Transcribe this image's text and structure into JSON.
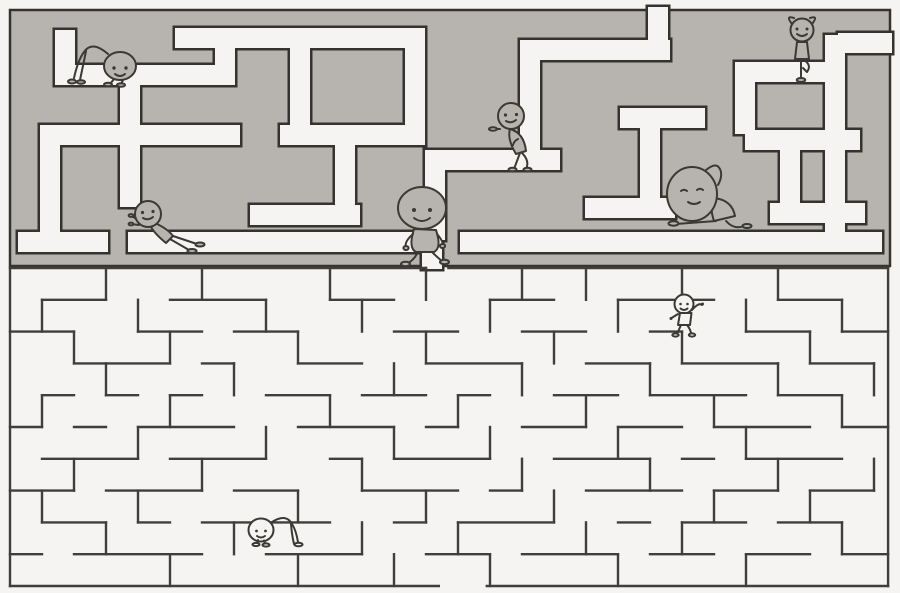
{
  "illustration": {
    "canvas": {
      "width": 900,
      "height": 593
    },
    "colors": {
      "paper": "#f5f4f2",
      "wall_gray": "#b7b4af",
      "line_dark": "#343330",
      "line_maze": "#3f3e3c",
      "char_line": "#3a3936"
    },
    "top_maze": {
      "bounds": [
        10,
        10,
        880,
        256
      ],
      "corridor_width": 20,
      "outline_width": 2.5,
      "corridors": [
        [
          648,
          7,
          20,
          53
        ],
        [
          175,
          28,
          250,
          20
        ],
        [
          520,
          40,
          150,
          20
        ],
        [
          838,
          33,
          54,
          20
        ],
        [
          55,
          30,
          20,
          55
        ],
        [
          55,
          65,
          180,
          20
        ],
        [
          215,
          48,
          20,
          37
        ],
        [
          120,
          85,
          20,
          50
        ],
        [
          40,
          125,
          200,
          20
        ],
        [
          280,
          125,
          145,
          20
        ],
        [
          620,
          108,
          85,
          20
        ],
        [
          745,
          130,
          115,
          20
        ],
        [
          40,
          145,
          20,
          107
        ],
        [
          290,
          48,
          20,
          87
        ],
        [
          405,
          48,
          20,
          87
        ],
        [
          520,
          60,
          20,
          110
        ],
        [
          425,
          150,
          135,
          20
        ],
        [
          425,
          170,
          20,
          70
        ],
        [
          250,
          205,
          110,
          20
        ],
        [
          335,
          145,
          20,
          70
        ],
        [
          585,
          198,
          90,
          20
        ],
        [
          640,
          128,
          20,
          80
        ],
        [
          770,
          203,
          95,
          20
        ],
        [
          825,
          35,
          20,
          217
        ],
        [
          780,
          150,
          20,
          55
        ],
        [
          735,
          62,
          110,
          20
        ],
        [
          735,
          82,
          20,
          52
        ],
        [
          18,
          232,
          90,
          20
        ],
        [
          128,
          232,
          314,
          20
        ],
        [
          460,
          232,
          422,
          20
        ],
        [
          422,
          232,
          20,
          37
        ],
        [
          120,
          145,
          20,
          62
        ]
      ]
    },
    "bottom_maze": {
      "origin": [
        10,
        268
      ],
      "cell": [
        32,
        31.8
      ],
      "line_width": 2.4,
      "walls": [
        [
          0,
          0,
          13,
          0
        ],
        [
          13.7,
          0,
          27.44,
          0
        ],
        [
          0,
          10,
          13.4,
          10
        ],
        [
          14.9,
          10,
          27.44,
          10
        ],
        [
          0,
          0,
          0,
          10
        ],
        [
          27.44,
          0,
          27.44,
          10
        ],
        [
          1,
          1,
          3,
          1
        ],
        [
          5,
          1,
          8,
          1
        ],
        [
          10,
          1,
          12,
          1
        ],
        [
          15,
          1,
          17,
          1
        ],
        [
          19,
          1,
          22,
          1
        ],
        [
          24,
          1,
          26,
          1
        ],
        [
          0,
          2,
          2,
          2
        ],
        [
          4,
          2,
          6,
          2
        ],
        [
          7,
          2,
          9,
          2
        ],
        [
          12,
          2,
          14,
          2
        ],
        [
          16,
          2,
          18,
          2
        ],
        [
          20,
          2,
          21,
          2
        ],
        [
          23,
          2,
          25,
          2
        ],
        [
          26,
          2,
          27.44,
          2
        ],
        [
          2,
          3,
          5,
          3
        ],
        [
          6,
          3,
          7,
          3
        ],
        [
          9,
          3,
          11,
          3
        ],
        [
          13,
          3,
          16,
          3
        ],
        [
          18,
          3,
          20,
          3
        ],
        [
          21,
          3,
          24,
          3
        ],
        [
          25,
          3,
          27,
          3
        ],
        [
          1,
          4,
          2,
          4
        ],
        [
          3,
          4,
          4,
          4
        ],
        [
          5,
          4,
          6,
          4
        ],
        [
          8,
          4,
          10,
          4
        ],
        [
          11,
          4,
          13,
          4
        ],
        [
          14,
          4,
          15,
          4
        ],
        [
          17,
          4,
          19,
          4
        ],
        [
          20,
          4,
          23,
          4
        ],
        [
          24,
          4,
          26,
          4
        ],
        [
          0,
          5,
          1,
          5
        ],
        [
          2,
          5,
          3,
          5
        ],
        [
          4,
          5,
          7,
          5
        ],
        [
          9,
          5,
          12,
          5
        ],
        [
          13,
          5,
          14,
          5
        ],
        [
          16,
          5,
          18,
          5
        ],
        [
          19,
          5,
          21,
          5
        ],
        [
          22,
          5,
          25,
          5
        ],
        [
          26,
          5,
          27.44,
          5
        ],
        [
          1,
          6,
          4,
          6
        ],
        [
          5,
          6,
          8,
          6
        ],
        [
          10,
          6,
          11,
          6
        ],
        [
          12,
          6,
          15,
          6
        ],
        [
          17,
          6,
          20,
          6
        ],
        [
          21,
          6,
          22,
          6
        ],
        [
          23,
          6,
          26,
          6
        ],
        [
          0,
          7,
          2,
          7
        ],
        [
          3,
          7,
          6,
          7
        ],
        [
          7,
          7,
          9,
          7
        ],
        [
          11,
          7,
          14,
          7
        ],
        [
          15,
          7,
          16,
          7
        ],
        [
          18,
          7,
          21,
          7
        ],
        [
          22,
          7,
          24,
          7
        ],
        [
          25,
          7,
          27,
          7
        ],
        [
          1,
          8,
          3,
          8
        ],
        [
          4,
          8,
          5,
          8
        ],
        [
          6,
          8,
          10,
          8
        ],
        [
          12,
          8,
          13,
          8
        ],
        [
          14,
          8,
          17,
          8
        ],
        [
          19,
          8,
          20,
          8
        ],
        [
          21,
          8,
          23,
          8
        ],
        [
          24,
          8,
          26,
          8
        ],
        [
          0,
          9,
          1,
          9
        ],
        [
          2,
          9,
          6,
          9
        ],
        [
          8,
          9,
          11,
          9
        ],
        [
          13,
          9,
          15,
          9
        ],
        [
          16,
          9,
          19,
          9
        ],
        [
          20,
          9,
          22,
          9
        ],
        [
          23,
          9,
          25,
          9
        ],
        [
          26,
          9,
          27.44,
          9
        ],
        [
          1,
          1,
          1,
          2
        ],
        [
          1,
          4,
          1,
          5
        ],
        [
          1,
          7,
          1,
          8
        ],
        [
          2,
          2,
          2,
          3
        ],
        [
          2,
          6,
          2,
          7
        ],
        [
          3,
          0,
          3,
          1
        ],
        [
          3,
          3,
          3,
          4
        ],
        [
          3,
          8,
          3,
          9
        ],
        [
          4,
          1,
          4,
          2
        ],
        [
          4,
          5,
          4,
          6
        ],
        [
          4,
          7,
          4,
          8
        ],
        [
          5,
          2,
          5,
          3
        ],
        [
          5,
          4,
          5,
          5
        ],
        [
          5,
          9,
          5,
          10
        ],
        [
          6,
          0,
          6,
          1
        ],
        [
          6,
          6,
          6,
          7
        ],
        [
          7,
          3,
          7,
          4
        ],
        [
          7,
          8,
          7,
          9
        ],
        [
          8,
          1,
          8,
          2
        ],
        [
          8,
          5,
          8,
          6
        ],
        [
          9,
          2,
          9,
          3
        ],
        [
          9,
          7,
          9,
          8
        ],
        [
          9,
          9,
          9,
          10
        ],
        [
          10,
          0,
          10,
          1
        ],
        [
          10,
          4,
          10,
          5
        ],
        [
          11,
          1,
          11,
          2
        ],
        [
          11,
          6,
          11,
          7
        ],
        [
          11,
          8,
          11,
          9
        ],
        [
          12,
          3,
          12,
          4
        ],
        [
          12,
          5,
          12,
          6
        ],
        [
          12,
          9,
          12,
          10
        ],
        [
          13,
          0,
          13,
          1
        ],
        [
          13,
          2,
          13,
          3
        ],
        [
          13,
          7,
          13,
          8
        ],
        [
          14,
          4,
          14,
          5
        ],
        [
          14,
          8,
          14,
          9
        ],
        [
          15,
          1,
          15,
          2
        ],
        [
          15,
          5,
          15,
          6
        ],
        [
          15,
          9,
          15,
          10
        ],
        [
          16,
          0,
          16,
          1
        ],
        [
          16,
          3,
          16,
          4
        ],
        [
          16,
          6,
          16,
          7
        ],
        [
          17,
          2,
          17,
          3
        ],
        [
          17,
          7,
          17,
          8
        ],
        [
          18,
          0,
          18,
          1
        ],
        [
          18,
          4,
          18,
          5
        ],
        [
          18,
          8,
          18,
          9
        ],
        [
          19,
          1,
          19,
          2
        ],
        [
          19,
          5,
          19,
          6
        ],
        [
          19,
          9,
          19,
          10
        ],
        [
          20,
          3,
          20,
          4
        ],
        [
          20,
          6,
          20,
          7
        ],
        [
          21,
          0,
          21,
          1
        ],
        [
          21,
          2,
          21,
          3
        ],
        [
          21,
          8,
          21,
          9
        ],
        [
          22,
          4,
          22,
          5
        ],
        [
          22,
          7,
          22,
          8
        ],
        [
          23,
          1,
          23,
          2
        ],
        [
          23,
          5,
          23,
          6
        ],
        [
          23,
          9,
          23,
          10
        ],
        [
          24,
          0,
          24,
          1
        ],
        [
          24,
          3,
          24,
          4
        ],
        [
          24,
          6,
          24,
          7
        ],
        [
          25,
          2,
          25,
          3
        ],
        [
          25,
          7,
          25,
          8
        ],
        [
          26,
          1,
          26,
          2
        ],
        [
          26,
          4,
          26,
          5
        ],
        [
          26,
          8,
          26,
          9
        ],
        [
          27,
          3,
          27,
          4
        ],
        [
          27,
          6,
          27,
          7
        ]
      ]
    },
    "characters": [
      {
        "name": "crawling-figure-top-left",
        "pose": "crawl-right",
        "x": 62,
        "y": 38,
        "fill": "wall_gray"
      },
      {
        "name": "yoga-tree-pose-figure",
        "pose": "tree-pose",
        "x": 776,
        "y": 14,
        "fill": "wall_gray"
      },
      {
        "name": "leaning-figure",
        "pose": "lean-back",
        "x": 490,
        "y": 99,
        "fill": "wall_gray"
      },
      {
        "name": "wall-pushing-figure",
        "pose": "push-wall",
        "x": 128,
        "y": 196,
        "fill": "wall_gray"
      },
      {
        "name": "walking-figure-center",
        "pose": "walk-right",
        "x": 392,
        "y": 186,
        "fill": "wall_gray"
      },
      {
        "name": "sitting-stretch-figure",
        "pose": "sit-stretch",
        "x": 664,
        "y": 160,
        "fill": "wall_gray"
      },
      {
        "name": "waving-figure-lower-maze",
        "pose": "wave",
        "x": 664,
        "y": 292,
        "fill": "paper"
      },
      {
        "name": "crawling-figure-bottom",
        "pose": "crawl-left",
        "x": 246,
        "y": 512,
        "fill": "paper"
      }
    ]
  }
}
